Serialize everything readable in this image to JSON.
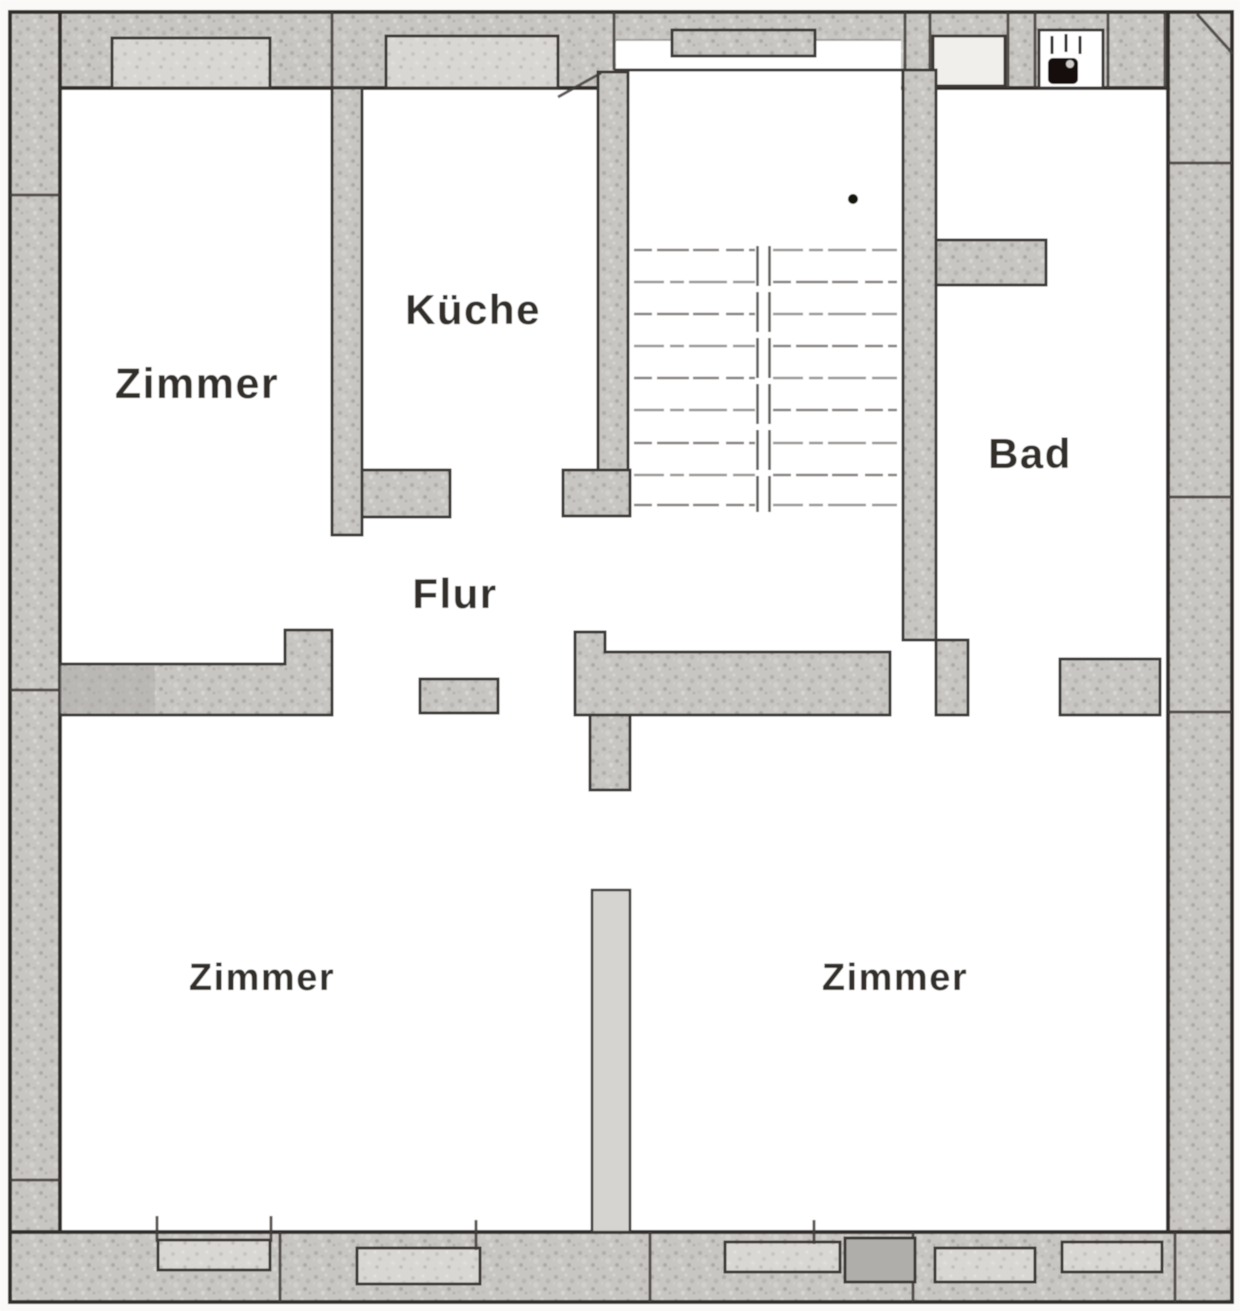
{
  "plan": {
    "rooms": {
      "zimmer_top_left": {
        "label": "Zimmer"
      },
      "kueche": {
        "label": "Küche"
      },
      "flur": {
        "label": "Flur"
      },
      "bad": {
        "label": "Bad"
      },
      "zimmer_bottom_left": {
        "label": "Zimmer"
      },
      "zimmer_bottom_right": {
        "label": "Zimmer"
      }
    },
    "icons": {
      "bad_fixture": "boiler-icon"
    },
    "colors": {
      "paper": "#faf9f7",
      "room_fill": "#ffffff",
      "wall_fill": "#c8c6c2",
      "wall_edge": "#3b3835",
      "label_text": "#201d1a"
    }
  }
}
